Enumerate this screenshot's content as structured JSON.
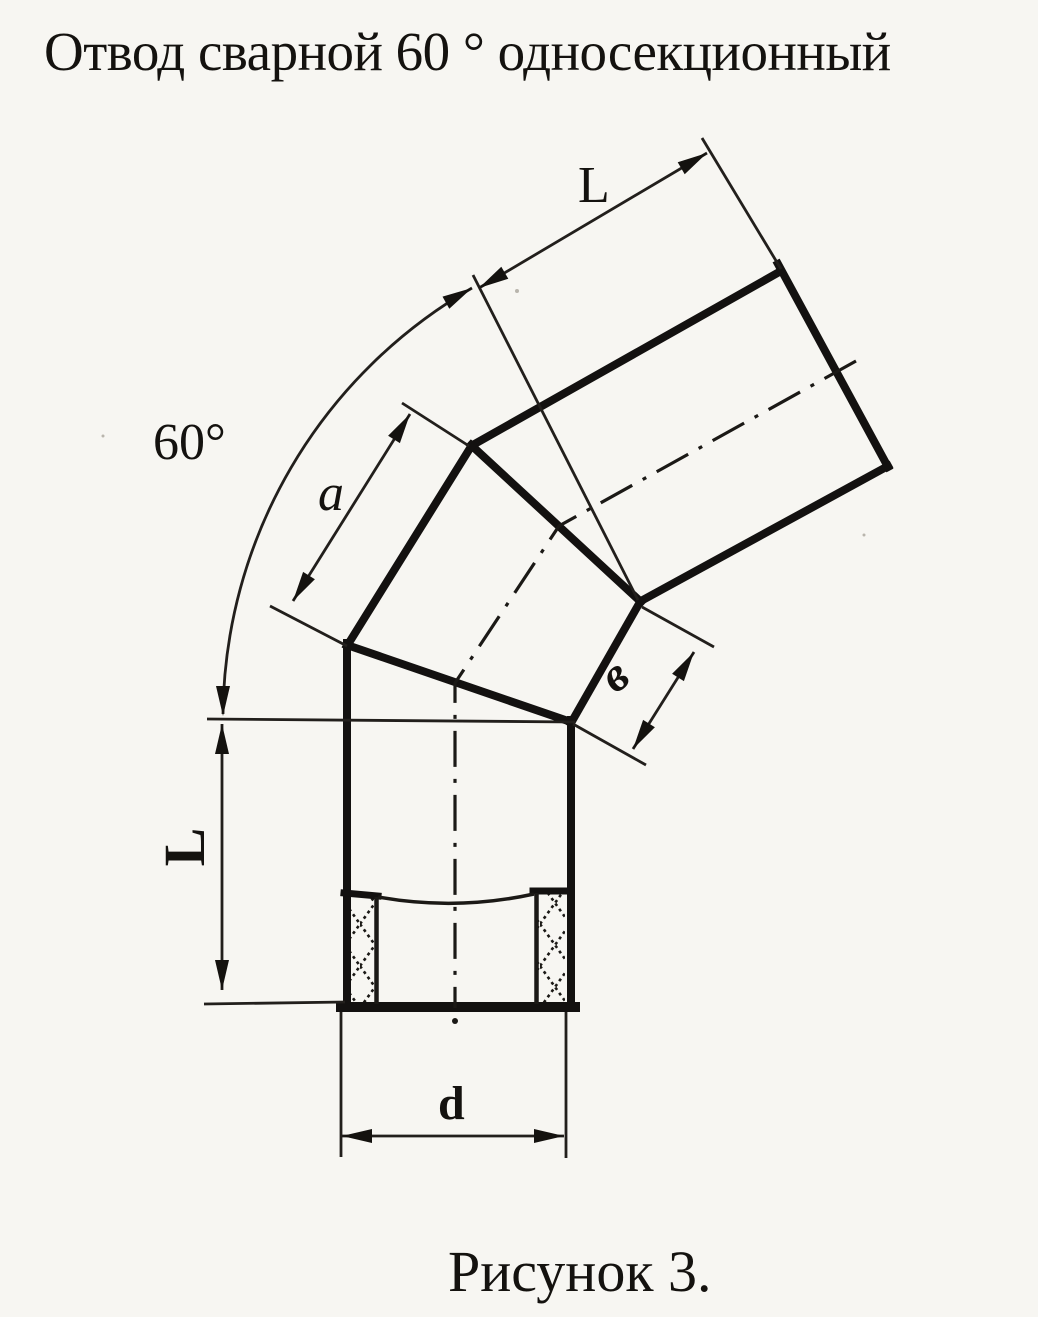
{
  "title": "Отвод сварной 60 ° односекционный",
  "caption": "Рисунок 3.",
  "part": {
    "type": "welded pipe elbow, single-section",
    "bend_angle": "60°",
    "figure_number": "3"
  },
  "labels": {
    "angle": "60°",
    "length_top": "L",
    "length_left": "L",
    "middle_section_long_side": "a",
    "middle_section_short_side": "в",
    "diameter": "d"
  },
  "colors": {
    "paper": "#f7f6f2",
    "ink": "#14120f"
  }
}
